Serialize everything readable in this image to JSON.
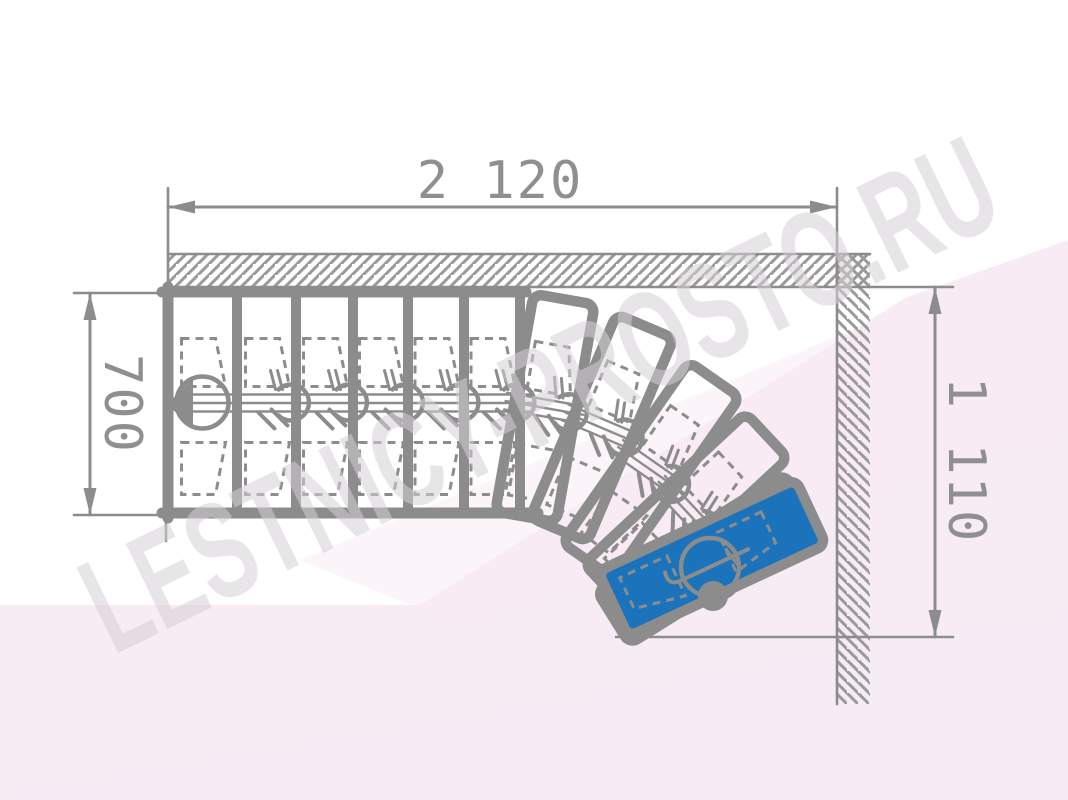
{
  "watermark": {
    "text": "LESTNICY-PROSTO.RU",
    "color": "#d6d0d6"
  },
  "dimensions": {
    "top_width": "2 120",
    "left_depth": "700",
    "right_height": "1 110"
  },
  "colors": {
    "line": "#8c8c8c",
    "hatch": "#9a9a9a",
    "text": "#8f8f8f",
    "blue_tread": "#1b73bc",
    "bg1": "#f8ecf4",
    "bg2": "#f7ebf3",
    "bg3": "#f5ecf6"
  },
  "plan": {
    "canvas": [
      1068,
      800
    ],
    "background": [
      {
        "pts": "0,605 420,605 905,298 1068,240 1068,800 0,800",
        "fill": "#f8ecf4",
        "op": 1
      },
      {
        "pts": "300,560 1068,240 1068,430 460,625",
        "fill": "#f7ebf3",
        "op": 0.55
      },
      {
        "pts": "0,800 1068,618 1068,800",
        "fill": "#f5ecf6",
        "op": 1
      }
    ],
    "walls": {
      "top": {
        "rect": [
          168,
          254,
          702,
          33
        ]
      },
      "right": {
        "rect": [
          837,
          254,
          33,
          450
        ]
      },
      "lines": [
        [
          168,
          254,
          870,
          254
        ],
        [
          168,
          287,
          837,
          287
        ],
        [
          837,
          254,
          837,
          704
        ]
      ]
    },
    "run": {
      "top": 292,
      "bottom": 513,
      "left": 168,
      "right_ext": 526,
      "tread_edges": [
        168,
        237,
        296,
        353,
        408,
        464,
        520
      ]
    },
    "spine": {
      "x1": 178,
      "x2": 532,
      "cy": 403,
      "gap": 8.5
    },
    "start_arrow": "193,379 193,429 167,404",
    "stub": [
      166,
      513,
      166,
      541
    ],
    "tread": {
      "w": 62,
      "h": 221
    },
    "winders": [
      [
        545,
        408,
        10
      ],
      [
        602,
        428,
        23
      ],
      [
        651,
        470,
        35
      ],
      [
        686,
        511,
        47
      ],
      [
        707,
        559,
        58
      ]
    ],
    "exit": {
      "cx": 712,
      "cy": 558,
      "a": 65,
      "w": 72,
      "h": 218,
      "dot": [
        713,
        596,
        15
      ],
      "sym": [
        710,
        567,
        29
      ]
    },
    "dims": {
      "top": {
        "line": [
          168,
          207,
          837,
          207
        ],
        "ext": [
          [
            168,
            188,
            168,
            292
          ],
          [
            837,
            188,
            837,
            287
          ]
        ]
      },
      "left": {
        "line": [
          90,
          293,
          90,
          515
        ],
        "ext": [
          [
            74,
            293,
            168,
            293
          ],
          [
            74,
            515,
            532,
            515
          ]
        ]
      },
      "right": {
        "line": [
          935,
          287,
          935,
          637
        ],
        "ext": [
          [
            837,
            287,
            953,
            287
          ],
          [
            616,
            637,
            953,
            637
          ]
        ]
      }
    }
  }
}
